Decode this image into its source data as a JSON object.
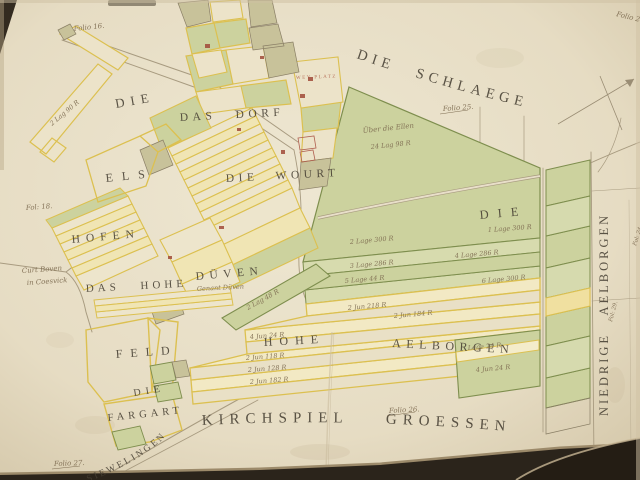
{
  "map": {
    "region_labels": [
      {
        "id": "die-schlaege",
        "text": "DIE SCHLAEGE"
      },
      {
        "id": "die-nw",
        "text": "DIE"
      },
      {
        "id": "das-dorf",
        "text": "DAS DORF"
      },
      {
        "id": "els",
        "text": "ELS"
      },
      {
        "id": "die-wourt",
        "text": "DIE WOURT"
      },
      {
        "id": "hofen",
        "text": "HOFEN"
      },
      {
        "id": "das-hohe",
        "text": "DAS HOHE"
      },
      {
        "id": "duven",
        "text": "DÜVEN"
      },
      {
        "id": "feld",
        "text": "FELD"
      },
      {
        "id": "fargart-die",
        "text": "DIE"
      },
      {
        "id": "fargart",
        "text": "FARGART"
      },
      {
        "id": "hohe",
        "text": "HOHE"
      },
      {
        "id": "aelborgen",
        "text": "AELBORGEN"
      },
      {
        "id": "die-field",
        "text": "DIE"
      },
      {
        "id": "kirchspiel-groessen",
        "text": "KIRCHSPIEL GROESSEN"
      },
      {
        "id": "siewelingen",
        "text": "SIEWELINGEN"
      },
      {
        "id": "niedrige-aelborgen",
        "text": "NIEDRIGE AELBORGEN"
      },
      {
        "id": "wey-platz",
        "text": "WEY PLATZ"
      }
    ],
    "folio_notes": [
      {
        "text": "Folio 16."
      },
      {
        "text": "Folio 25."
      },
      {
        "text": "Fol: 18."
      },
      {
        "text": "Folio 27."
      },
      {
        "text": "Folio 26."
      },
      {
        "text": "Folio 24."
      },
      {
        "text": "Fol: 24."
      },
      {
        "text": "Fol: 29."
      }
    ],
    "annotations": [
      {
        "text": "Über die Ellen"
      },
      {
        "text": "24 Lag 98 R"
      },
      {
        "text": "Curt Boven"
      },
      {
        "text": "in Coesvick"
      },
      {
        "text": "Genant Düven"
      },
      {
        "text": "2 Lag 90 R"
      },
      {
        "text": "2 Lag 48 R"
      },
      {
        "text": "1 Lage 300 R"
      },
      {
        "text": "2 Lage 300 R"
      },
      {
        "text": "3 Lage 286 R"
      },
      {
        "text": "4 Lage 286 R"
      },
      {
        "text": "5 Lage 44 R"
      },
      {
        "text": "6 Lage 300 R"
      },
      {
        "text": "2 Jun 218 R"
      },
      {
        "text": "2 Jun 184 R"
      },
      {
        "text": "4 Jun 24 R"
      },
      {
        "text": "2 Jun 118 R"
      },
      {
        "text": "2 Jun 128 R"
      },
      {
        "text": "2 Jun 182 R"
      },
      {
        "text": "Lage 24 R"
      },
      {
        "text": "4 Jun 24 R"
      }
    ],
    "palette": {
      "paper": "#e8dfc9",
      "field_green": "#ccd29e",
      "field_green_light": "#d7dbae",
      "field_olive": "#c8c29a",
      "outline_yellow": "#dcc050",
      "outline_green": "#7e8e4e",
      "ink": "#463f33",
      "cursive_ink": "#7d6b50",
      "road": "#a89b80",
      "page_edge": "#2b241b",
      "red_accent": "#a04a38"
    }
  }
}
